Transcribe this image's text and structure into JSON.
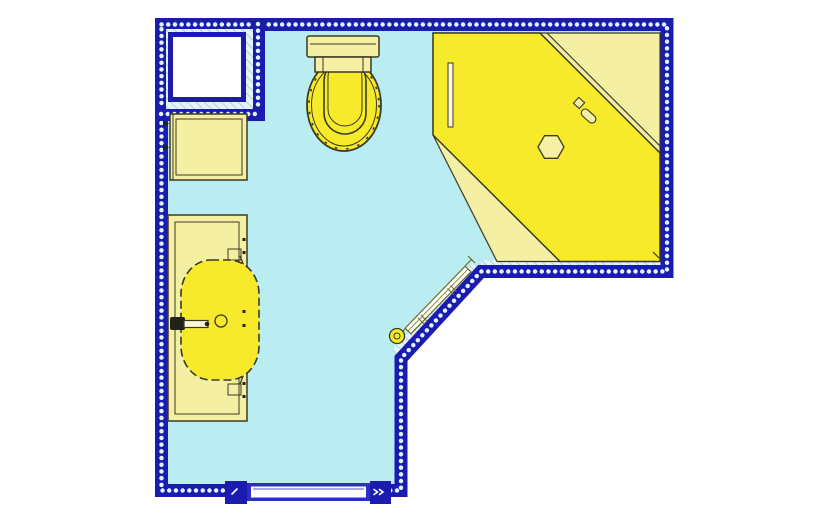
{
  "meta": {
    "type": "architectural-floor-plan",
    "subject": "Bathroom floor plan, top view, L-shaped room with chamfered corner"
  },
  "colors": {
    "background": "#ffffff",
    "wall": "#1c1bb0",
    "wall_dots": "#dff6fb",
    "floor": "#b9edf2",
    "fixture_bright": "#f7ea2b",
    "fixture_pale": "#f5efa3",
    "outline": "#3a3a23",
    "outline_dark": "#22221a",
    "hatch_bg": "#e2f4f7",
    "hatch_line": "#9fb4cd",
    "door_frame": "#2f2ec2",
    "white": "#ffffff"
  },
  "fixtures": {
    "shaft": {
      "label": "boxed duct shaft"
    },
    "wall_cabinet": {
      "label": "wall cabinet"
    },
    "toilet": {
      "label": "toilet with cistern"
    },
    "shower": {
      "label": "corner shower with diagonal sliding door"
    },
    "shower_drain": {
      "label": "hexagonal drain cap"
    },
    "shower_handle": {
      "label": "shower door handle"
    },
    "vanity": {
      "label": "vanity counter with basin"
    },
    "faucet": {
      "label": "basin mixer tap"
    },
    "radiator": {
      "label": "towel radiator on chamfer wall"
    },
    "radiator_valve": {
      "label": "radiator thermostat valve"
    },
    "entry_door": {
      "label": "sliding entry door"
    }
  }
}
